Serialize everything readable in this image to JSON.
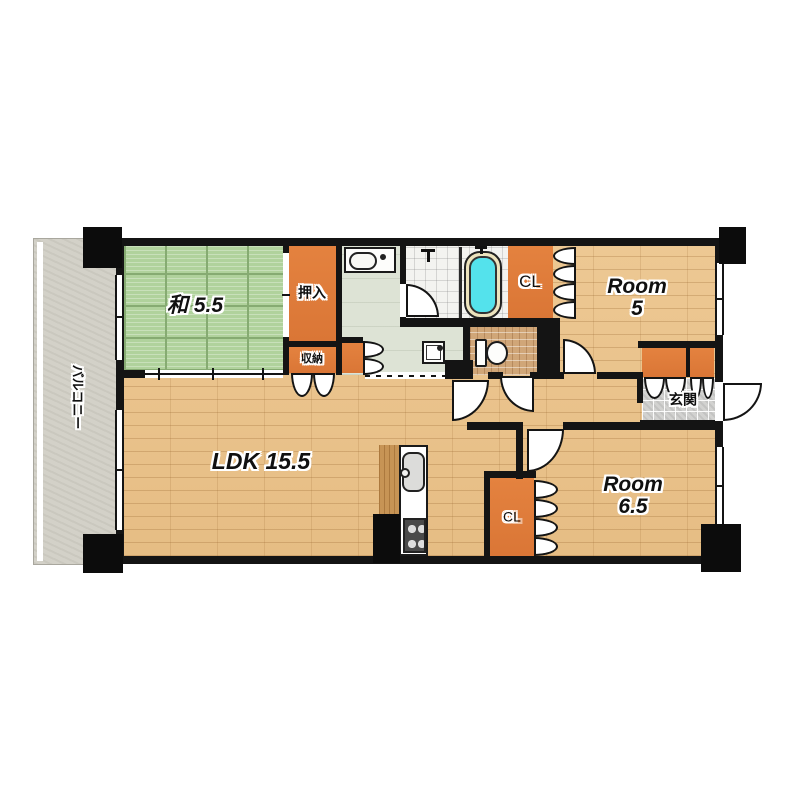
{
  "plan_title": "2LDK apartment floor plan",
  "rooms": {
    "tatami": {
      "label": "和 5.5"
    },
    "ldk": {
      "label": "LDK 15.5"
    },
    "room5": {
      "line1": "Room",
      "line2": "5"
    },
    "room6_5": {
      "line1": "Room",
      "line2": "6.5"
    }
  },
  "closets": {
    "oshiire": "押入",
    "shuno": "収納",
    "cl_room5": "CL",
    "cl_room6_5": "CL"
  },
  "areas": {
    "genkan": "玄関",
    "balcony": "バルコニー"
  },
  "fixtures": [
    "bathtub",
    "shower-faucet",
    "tub-faucet",
    "bathroom-sink",
    "toilet",
    "washer-pan",
    "kitchen-sink",
    "kitchen-stove"
  ],
  "colors": {
    "wall_black": "#141414",
    "wood_floor": "#e9c38f",
    "tatami_green": "#b0d29c",
    "closet_orange": "#e07c3a",
    "balcony_gray": "#d3d1c8",
    "washroom_sage": "#dde3d5",
    "genkan_tile": "#d2d2d0",
    "toilet_mosaic": "#d0a678",
    "bathtub_cyan": "#54e2ec",
    "tub_rim_cream": "#ece3bd"
  }
}
